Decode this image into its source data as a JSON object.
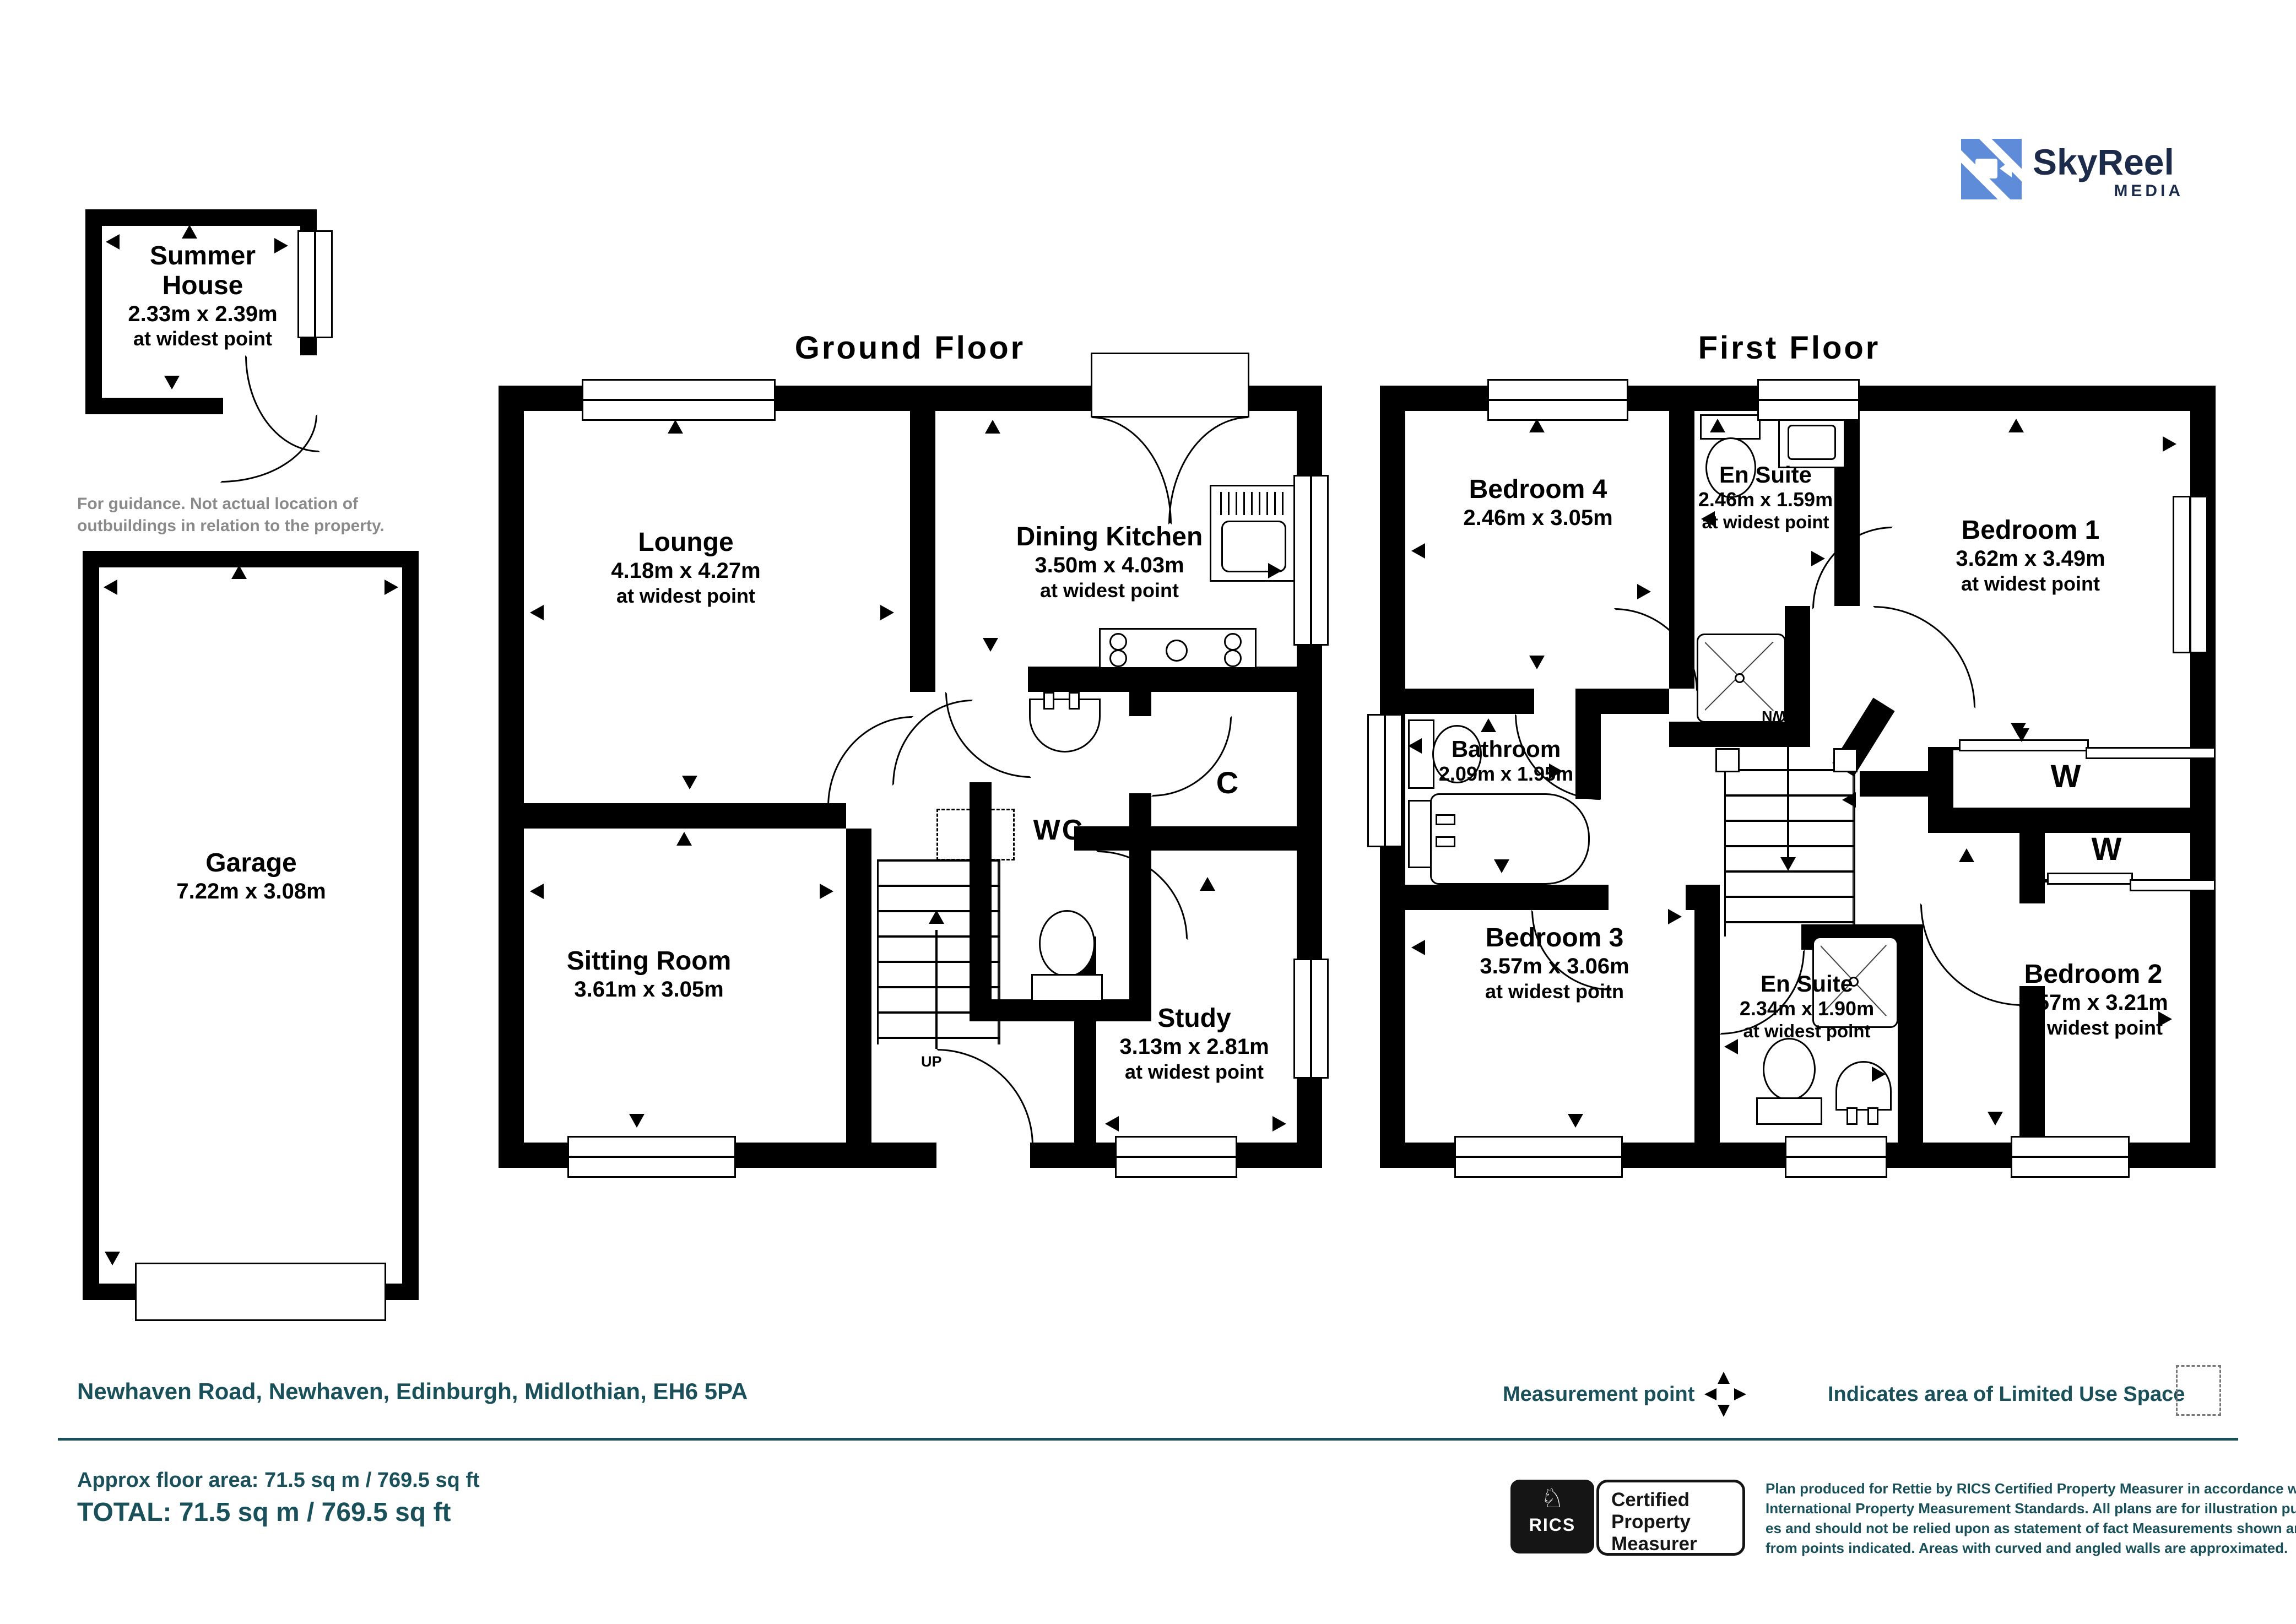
{
  "logo": {
    "name": "SkyReel",
    "tagline": "MEDIA"
  },
  "titles": {
    "ground": "Ground Floor",
    "first": "First Floor"
  },
  "summer_house": {
    "name": "Summer House",
    "dims": "2.33m x 2.39m",
    "note": "at widest point",
    "caption": "For guidance. Not actual location of outbuildings in relation to the property."
  },
  "garage": {
    "name": "Garage",
    "dims": "7.22m x 3.08m"
  },
  "ground": {
    "lounge": {
      "name": "Lounge",
      "dims": "4.18m x 4.27m",
      "note": "at widest point"
    },
    "dining_kitchen": {
      "name": "Dining Kitchen",
      "dims": "3.50m x 4.03m",
      "note": "at widest point"
    },
    "sitting_room": {
      "name": "Sitting Room",
      "dims": "3.61m x 3.05m"
    },
    "wc": {
      "name": "WC"
    },
    "cupboard": {
      "name": "C"
    },
    "study": {
      "name": "Study",
      "dims": "3.13m x 2.81m",
      "note": "at widest point"
    },
    "stairs": "UP"
  },
  "first": {
    "bedroom4": {
      "name": "Bedroom 4",
      "dims": "2.46m x 3.05m"
    },
    "ensuite1": {
      "name": "En Suite",
      "dims": "2.46m x 1.59m",
      "note": "at widest point"
    },
    "bedroom1": {
      "name": "Bedroom 1",
      "dims": "3.62m x 3.49m",
      "note": "at widest point"
    },
    "bathroom": {
      "name": "Bathroom",
      "dims": "2.09m x 1.95m"
    },
    "bedroom3": {
      "name": "Bedroom 3",
      "dims": "3.57m x 3.06m",
      "note": "at widest poitn"
    },
    "ensuite2": {
      "name": "En Suite",
      "dims": "2.34m x 1.90m",
      "note": "at widest point"
    },
    "bedroom2": {
      "name": "Bedroom 2",
      "dims": "3.57m x 3.21m",
      "note": "at widest point"
    },
    "wardrobe1": "W",
    "wardrobe2": "W",
    "stairs": "DOWN"
  },
  "footer": {
    "address": "Newhaven Road, Newhaven, Edinburgh, Midlothian, EH6 5PA",
    "measurement_point": "Measurement point",
    "limited_use": "Indicates area of  Limited Use Space",
    "approx_area": "Approx floor area: 71.5 sq m / 769.5 sq ft",
    "total": "TOTAL: 71.5 sq m / 769.5 sq ft",
    "rics_brand": "RICS",
    "rics_badge_l1": "Certified",
    "rics_badge_l2": "Property",
    "rics_badge_l3": "Measurer",
    "disclaimer_l1": "Plan produced for Rettie by RICS Certified Property Measurer in accordance with RICS",
    "disclaimer_l2": "International Property  Measurement Standards.  All plans are for illustration purpos-",
    "disclaimer_l3": "es and should not be relied upon as statement of fact Measurements shown are taken",
    "disclaimer_l4": "from points indicated. Areas with curved and angled walls are approximated."
  },
  "colors": {
    "teal": "#19505A",
    "logo_blue": "#5E8CD8",
    "logo_navy": "#1C2B4A",
    "caption_gray": "#8A8A8A"
  }
}
